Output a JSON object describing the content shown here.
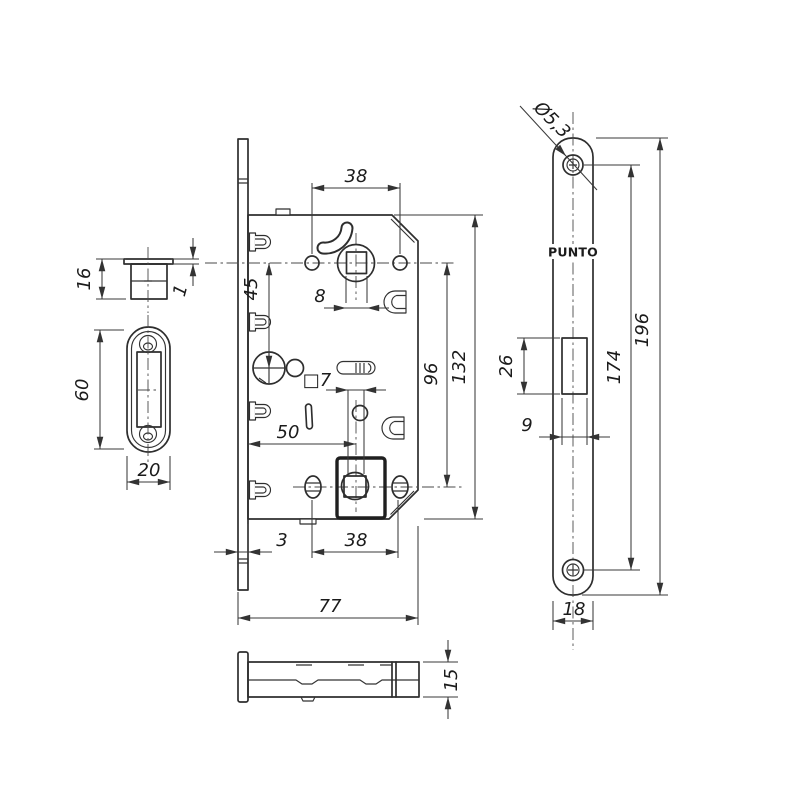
{
  "brand": {
    "label": "PUNTO"
  },
  "dims": {
    "strike_box_height": "16",
    "strike_box_flange": "1",
    "strike_plate_length": "60",
    "strike_plate_width": "20",
    "top_screw_spacing": "38",
    "handle_square": "8",
    "wc_square": "□7",
    "handle_to_wc": "45",
    "backset": "50",
    "screw_to_magnet": "96",
    "body_height": "132",
    "faceplate_offset": "3",
    "bottom_screw_spacing": "38",
    "body_width": "77",
    "screw_hole_dia": "Ø5,3",
    "latch_window_height": "26",
    "latch_window_width": "9",
    "faceplate_screw_spacing": "174",
    "faceplate_length": "196",
    "faceplate_width": "18",
    "body_thickness": "15"
  }
}
